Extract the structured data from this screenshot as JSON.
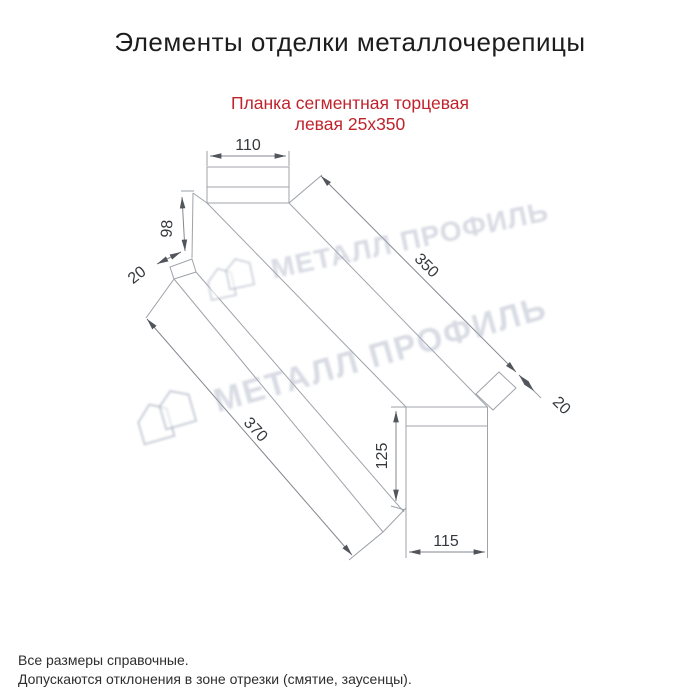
{
  "page": {
    "title": "Элементы отделки металлочерепицы",
    "subtitle_line1": "Планка сегментная торцевая",
    "subtitle_line2": "левая 25x350"
  },
  "watermark": {
    "brand": "МЕТАЛЛ ПРОФИЛЬ"
  },
  "drawing": {
    "dims": {
      "width_top": "110",
      "height_left": "98",
      "fold_left": "20",
      "length_top": "350",
      "length_bottom": "370",
      "fold_right": "20",
      "height_right": "125",
      "width_bottom": "115"
    }
  },
  "footer": {
    "line1": "Все размеры справочные.",
    "line2": "Допускаются отклонения в зоне отрезки (смятие, заусенцы)."
  },
  "colors": {
    "accent_red": "#c0232c",
    "line_gray": "#9fa3aa",
    "dim_gray": "#83878e",
    "watermark_gray": "#b9bfce"
  }
}
